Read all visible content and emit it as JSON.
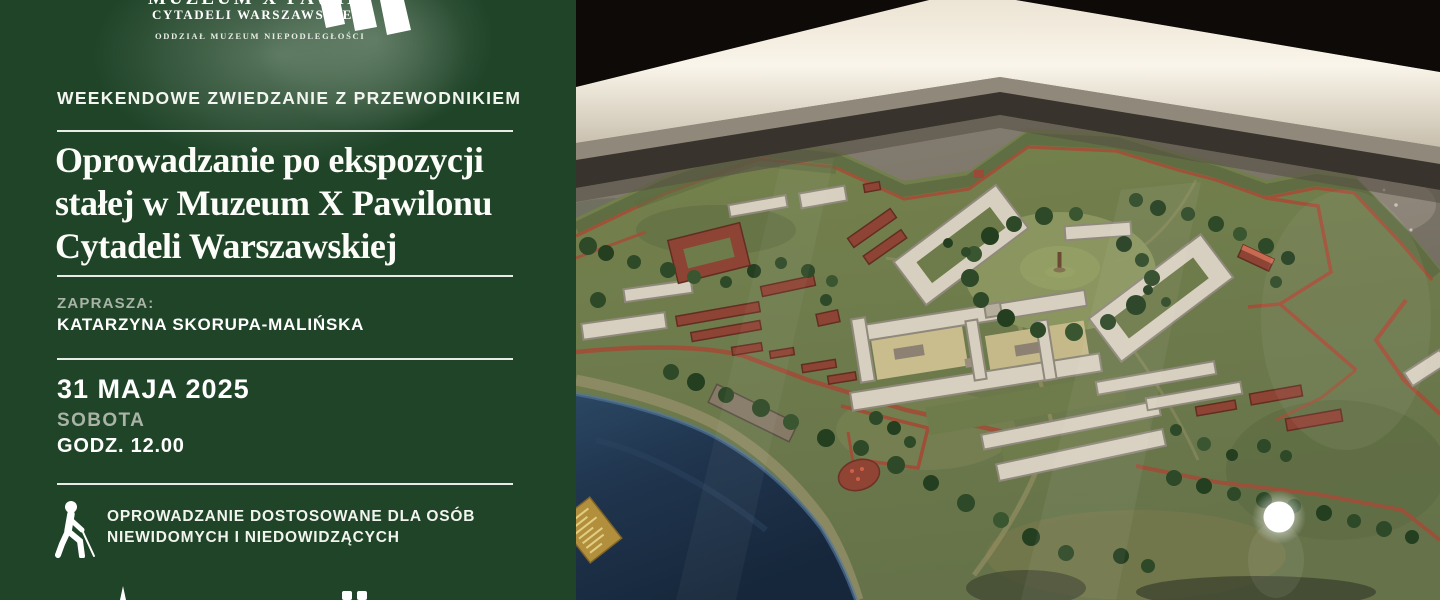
{
  "colors": {
    "panel_background": "#1f4428",
    "text_primary": "#ffffff",
    "text_muted": "#a9b4a7",
    "rule": "#e9ece6",
    "brick": "#9e4f38",
    "water": "#1f3550",
    "frame_light": "#f7f1e5"
  },
  "logo": {
    "partial_top_line": "MUZEUM X PAWILONU",
    "line1": "CYTADELI WARSZAWSKIEJ",
    "line2": "ODDZIAŁ MUZEUM NIEPODLEGŁOŚCI",
    "window_icon": "prison-window-icon"
  },
  "kicker": "WEEKENDOWE ZWIEDZANIE Z PRZEWODNIKIEM",
  "title": {
    "line1": "Oprowadzanie po ekspozycji",
    "line2": "stałej w Muzeum X Pawilonu",
    "line3": "Cytadeli Warszawskiej"
  },
  "invite": {
    "label": "ZAPRASZA:",
    "name": "KATARZYNA SKORUPA-MALIŃSKA"
  },
  "event": {
    "date": "31 MAJA 2025",
    "day": "SOBOTA",
    "time": "GODZ. 12.00"
  },
  "accessibility": {
    "icon": "blind-person-icon",
    "line1": "OPROWADZANIE DOSTOSOWANE DLA OSÓB",
    "line2": "NIEWIDOMYCH I NIEDOWIDZĄCYCH"
  },
  "photo": {
    "subject": "Scale model of the Warsaw Citadel in an illuminated museum display case"
  }
}
